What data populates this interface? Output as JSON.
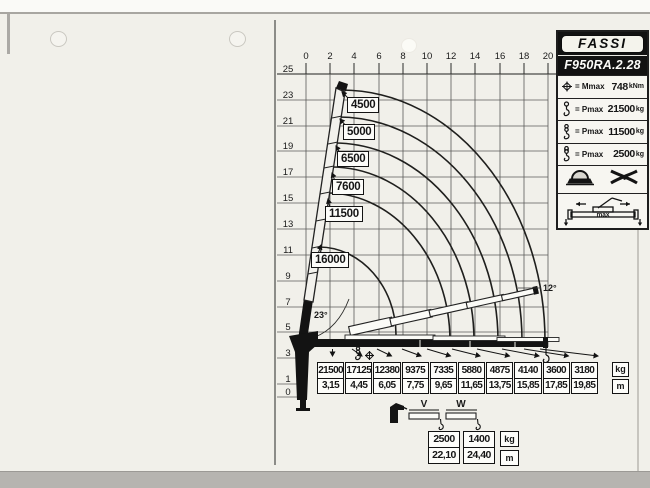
{
  "logo": "FASSI",
  "model": "F950RA.2.28",
  "specs": [
    {
      "icon": "moment-icon",
      "label": "= Mmax",
      "value": "748",
      "unit": "kNm"
    },
    {
      "icon": "hook-icon",
      "label": "= Pmax",
      "value": "21500",
      "unit": "kg"
    },
    {
      "icon": "double-hook-icon",
      "label": "= Pmax",
      "value": "11500",
      "unit": "kg"
    },
    {
      "icon": "winch-hook-icon",
      "label": "= Pmax",
      "value": "2500",
      "unit": "kg"
    }
  ],
  "stabilizer_label": "max",
  "chart": {
    "x_ticks": [
      "0",
      "2",
      "4",
      "6",
      "8",
      "10",
      "12",
      "14",
      "16",
      "18",
      "20"
    ],
    "y_ticks": [
      "25",
      "23",
      "21",
      "19",
      "17",
      "15",
      "13",
      "11",
      "9",
      "7",
      "5",
      "3",
      "1",
      "0"
    ],
    "curves": [
      "4500",
      "5000",
      "6500",
      "7600",
      "11500",
      "16000"
    ],
    "boom_angle_min": "23°",
    "jib_angle": "12°"
  },
  "load_table": {
    "kg": [
      "21500",
      "17125",
      "12380",
      "9375",
      "7335",
      "5880",
      "4875",
      "4140",
      "3600",
      "3180"
    ],
    "m": [
      "3,15",
      "4,45",
      "6,05",
      "7,75",
      "9,65",
      "11,65",
      "13,75",
      "15,85",
      "17,85",
      "19,85"
    ],
    "unit_kg": "kg",
    "unit_m": "m"
  },
  "manual_ext": {
    "v_label": "V",
    "w_label": "W",
    "kg": [
      "2500",
      "1400"
    ],
    "m": [
      "22,10",
      "24,40"
    ],
    "unit_kg": "kg",
    "unit_m": "m"
  },
  "chart_data": {
    "type": "line",
    "title": "F950RA.2.28",
    "x_range_m": [
      0,
      20
    ],
    "y_range_m": [
      0,
      25
    ],
    "load_points": [
      {
        "outreach_m": 3.15,
        "capacity_kg": 21500
      },
      {
        "outreach_m": 4.45,
        "capacity_kg": 17125
      },
      {
        "outreach_m": 6.05,
        "capacity_kg": 12380
      },
      {
        "outreach_m": 7.75,
        "capacity_kg": 9375
      },
      {
        "outreach_m": 9.65,
        "capacity_kg": 7335
      },
      {
        "outreach_m": 11.65,
        "capacity_kg": 5880
      },
      {
        "outreach_m": 13.75,
        "capacity_kg": 4875
      },
      {
        "outreach_m": 15.85,
        "capacity_kg": 4140
      },
      {
        "outreach_m": 17.85,
        "capacity_kg": 3600
      },
      {
        "outreach_m": 19.85,
        "capacity_kg": 3180
      }
    ],
    "curve_capacities_kg": [
      4500,
      5000,
      6500,
      7600,
      11500,
      16000
    ],
    "manual_extensions": [
      {
        "label": "V",
        "outreach_m": 22.1,
        "capacity_kg": 2500
      },
      {
        "label": "W",
        "outreach_m": 24.4,
        "capacity_kg": 1400
      }
    ],
    "boom_angles_deg": [
      23,
      12
    ],
    "specs": {
      "Mmax_kNm": 748,
      "Pmax_kg": [
        21500,
        11500,
        2500
      ]
    }
  }
}
